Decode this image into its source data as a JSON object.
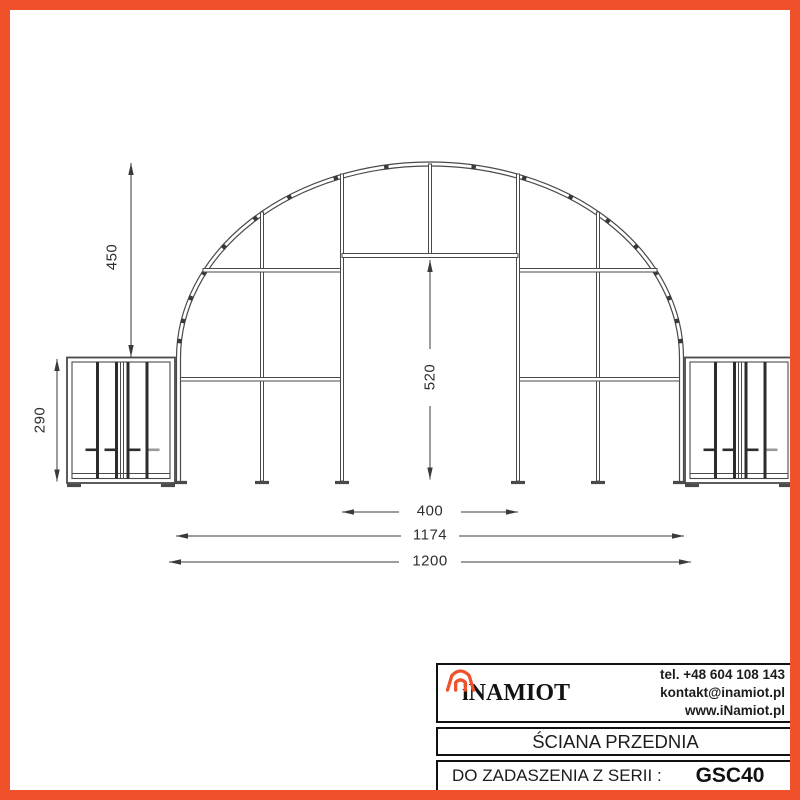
{
  "drawing": {
    "dimensions": {
      "arch_height": "450",
      "box_height": "290",
      "door_height": "520",
      "door_width": "400",
      "frame_span": "1174",
      "total_width": "1200"
    }
  },
  "title_block": {
    "brand": "iNAMIOT",
    "phone": "tel. +48 604 108 143",
    "email": "kontakt@inamiot.pl",
    "website": "www.iNamiot.pl",
    "drawing_title": "ŚCIANA PRZEDNIA",
    "series_label": "DO ZADASZENIA Z SERII :",
    "series_code": "GSC40"
  },
  "colors": {
    "accent": "#F0512B",
    "line": "#4a4a4a",
    "dark_bar": "#2c2c2c"
  }
}
